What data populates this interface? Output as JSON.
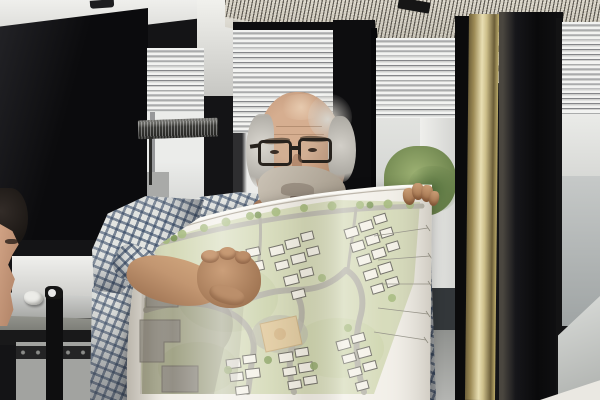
{
  "scene": {
    "type": "photograph",
    "setting": "Architecture office interior with black wall panels, four window bays with half-raised venetian blinds, and a suspended perforated-metal light fixture",
    "description": "An older man with glasses and a white beard, wearing a blue-and-white gingham shirt, stands in an office holding up a large curled architectural site plan; a colleague's profile is partly visible at the left edge",
    "people": {
      "presenter": {
        "description": "Older man, balding with white hair at the sides, dark rectangular glasses, white-grey beard, blue-and-white checked shirt, gripping the rolled site plan with both hands"
      },
      "colleague": {
        "description": "Partial profile of a second person at the far left edge, dark hair, facing right"
      }
    },
    "objects": {
      "site_plan": {
        "description": "Large curled paper masterplan: clusters of white building footprints with dark outlines, pale-green landscaping, grey looping access roads, a tan central plaza, grey existing buildings at left under the arm's shadow, and survey dimension lines fanning toward the right edge",
        "building_clusters": 6,
        "colors": {
          "paper": "#f2efe8",
          "landscape": "#d5dab8",
          "roads": "#b5b3a7",
          "buildings": "#f4f1e7",
          "building_outline": "#6a6860",
          "plaza": "#e2cba0",
          "existing_buildings": "#b5b3aa"
        }
      },
      "light_fixture": {
        "description": "Suspended perforated-metal luminaire across the top of the frame, supported by a brass-coloured pole"
      },
      "brass_pole": {
        "description": "Vertical brass support pole in front of the windows on the right",
        "color": "#cdbf8a"
      },
      "desk_lamp": {
        "description": "Dark perforated task-lamp head in front of the left window"
      },
      "windows": {
        "description": "Window bays with venetian blinds half raised; a neighbouring white building and green foliage visible outside",
        "blind_color": "#f2f3f1"
      },
      "table": {
        "description": "Grey metal work table at lower left with a crumpled paper scrap and a black tape dispenser on top"
      },
      "laptop": {
        "description": "Light grey laptop lid edge at the lower right corner"
      }
    },
    "palette": {
      "wall_black": "#0c0c0e",
      "ceiling_white": "#e9e9e6",
      "fixture_metal": "#c9c4b6",
      "shirt_check_blue": "#2a3e5c",
      "shirt_base": "#e3e5e2",
      "skin": "#c59a76",
      "hair_white": "#d6d3cb",
      "window_view": "#e3e4e1",
      "foliage": "#7d9758",
      "table_grey": "#bdbebc"
    }
  }
}
